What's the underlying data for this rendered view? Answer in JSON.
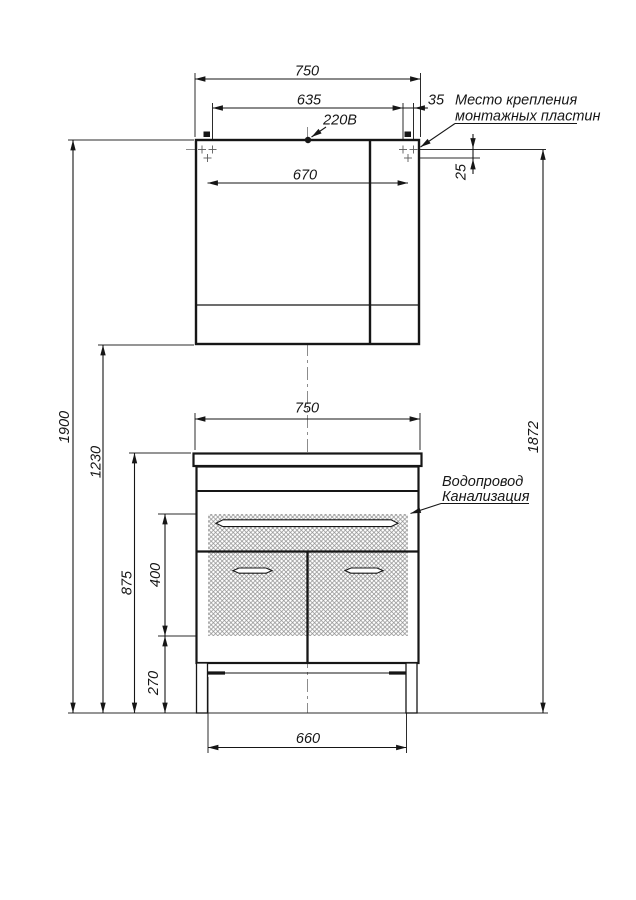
{
  "drawing": {
    "type": "furniture installation drawing (mirror cabinet and vanity unit), front view",
    "labels": {
      "power_socket": "220В",
      "mounting_plate_line1": "Место крепления",
      "mounting_plate_line2": "монтажных пластин",
      "water_supply": "Водопровод",
      "sewerage": "Канализация"
    },
    "dims": {
      "cabinet_width": "750",
      "mount_span_inner": "635",
      "mount_edge_offset": "35",
      "mount_span_outer": "670",
      "mount_row_gap": "25",
      "mount_height": "1872",
      "total_height": "1900",
      "cabinet_bottom_height": "1230",
      "vanity_height": "875",
      "service_zone_height": "400",
      "service_zone_floor_offset": "270",
      "vanity_width": "750",
      "base_width": "660"
    },
    "colors": {
      "line": "#161616",
      "centerline": "#8c8c8c",
      "hatch": "#8f8f8f",
      "background": "#ffffff"
    }
  }
}
